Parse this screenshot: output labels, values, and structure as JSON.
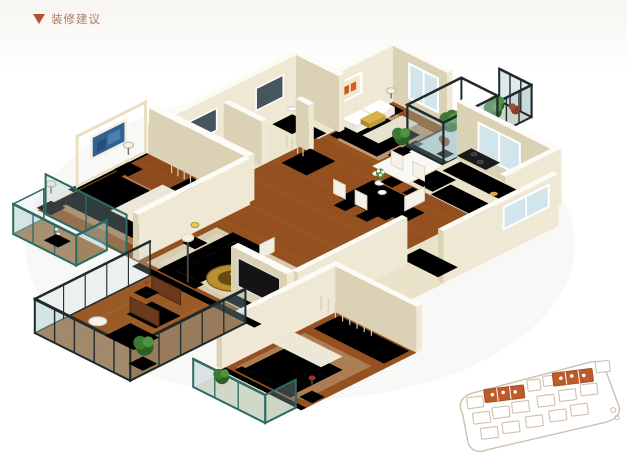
{
  "header": {
    "marker_icon": "triangle-down-icon",
    "title": "装修建议",
    "accent_color": "#b5512c",
    "title_color": "#ae7a5f"
  },
  "illustration": {
    "name": "isometric-apartment-3d-floorplan",
    "rooms": [
      "bedroom-2",
      "corner-balcony",
      "glass-conservatory",
      "kitchen",
      "bathroom-2",
      "bathroom-1",
      "hallway",
      "entry-hall",
      "dining-area",
      "master-bedroom",
      "master-balcony",
      "living-room",
      "bedroom-3",
      "bedroom-3-balcony",
      "main-balcony"
    ],
    "palette": {
      "wood_floor": "#94511f",
      "wood_floor_light": "#a05c26",
      "tile_floor": "#eae3c9",
      "wall_cream": "#efe8d4",
      "wall_shadow": "#dbd1b5",
      "wall_top": "#fcfbf6",
      "gold_feature_wall": "#c79f49",
      "painting_blue": "#2f6292",
      "painting_orange": "#d2601e",
      "glass_frame_dark": "#20292b",
      "glass_frame_teal": "#2d6b63",
      "teal_accent": "#2e8f96",
      "sofa_white": "#f4f0e3",
      "plant_green": "#3c7a33",
      "tv_black": "#141414",
      "cabinet_wood": "#7c4017",
      "cabinet_gray": "#9aa1a6"
    }
  },
  "site_sketch": {
    "name": "site-plan-sketch",
    "outline_color": "#cfc0ac",
    "highlight_color": "#bf5a2b",
    "highlighted_clusters": 2
  }
}
